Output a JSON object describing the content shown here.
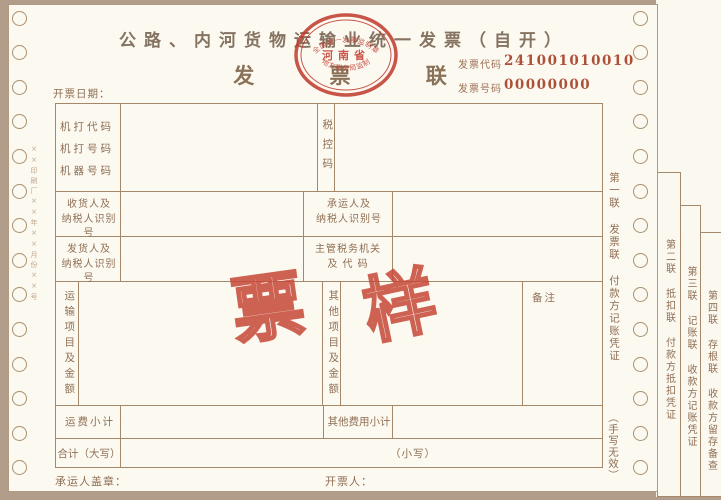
{
  "header": {
    "title": "公路、内河货物运输业统一发票（自开）",
    "copy_name": "发  票  联",
    "invoice_code_label": "发票代码",
    "invoice_code": "241001010010",
    "invoice_no_label": "发票号码",
    "invoice_no": "00000000",
    "issue_date_label": "开票日期："
  },
  "stamp": {
    "top_arc": "全国统一发票监制章",
    "center": "河南省",
    "bottom_arc": "地方税务局监制",
    "color": "#c0392b"
  },
  "watermark": {
    "left_char": "票",
    "right_char": "样",
    "color": "#c64837"
  },
  "form": {
    "machine_code_labels": "机打代码\n机打号码\n机器号码",
    "tax_control_code_label": "税控码",
    "consignee_taxid_label": "收货人及\n纳税人识别号",
    "carrier_taxid_label": "承运人及\n纳税人识别号",
    "shipper_taxid_label": "发货人及\n纳税人识别号",
    "tax_authority_label": "主管税务机关\n及 代 码",
    "transport_items_label": "运输项目及金额",
    "other_items_label": "其他项目及金额",
    "remarks_label": "备注",
    "freight_subtotal_label": "运费小计",
    "other_fees_subtotal_label": "其他费用小计",
    "total_in_words_label": "合计（大写）",
    "total_in_figures_label": "（小写）",
    "carrier_seal_label": "承运人盖章：",
    "issuer_label": "开票人："
  },
  "copies": {
    "copy1_note": "第一联 发票联 付款方记账凭证",
    "handwriting_invalid_note": "（手写无效）",
    "copy2_note": "第二联 抵扣联 付款方抵扣凭证",
    "copy3_note": "第三联 记账联 收款方记账凭证",
    "copy4_note": "第四联 存根联 收款方留存备查"
  },
  "edge": {
    "printer_mark": "××印刷厂××年××月份××号"
  }
}
